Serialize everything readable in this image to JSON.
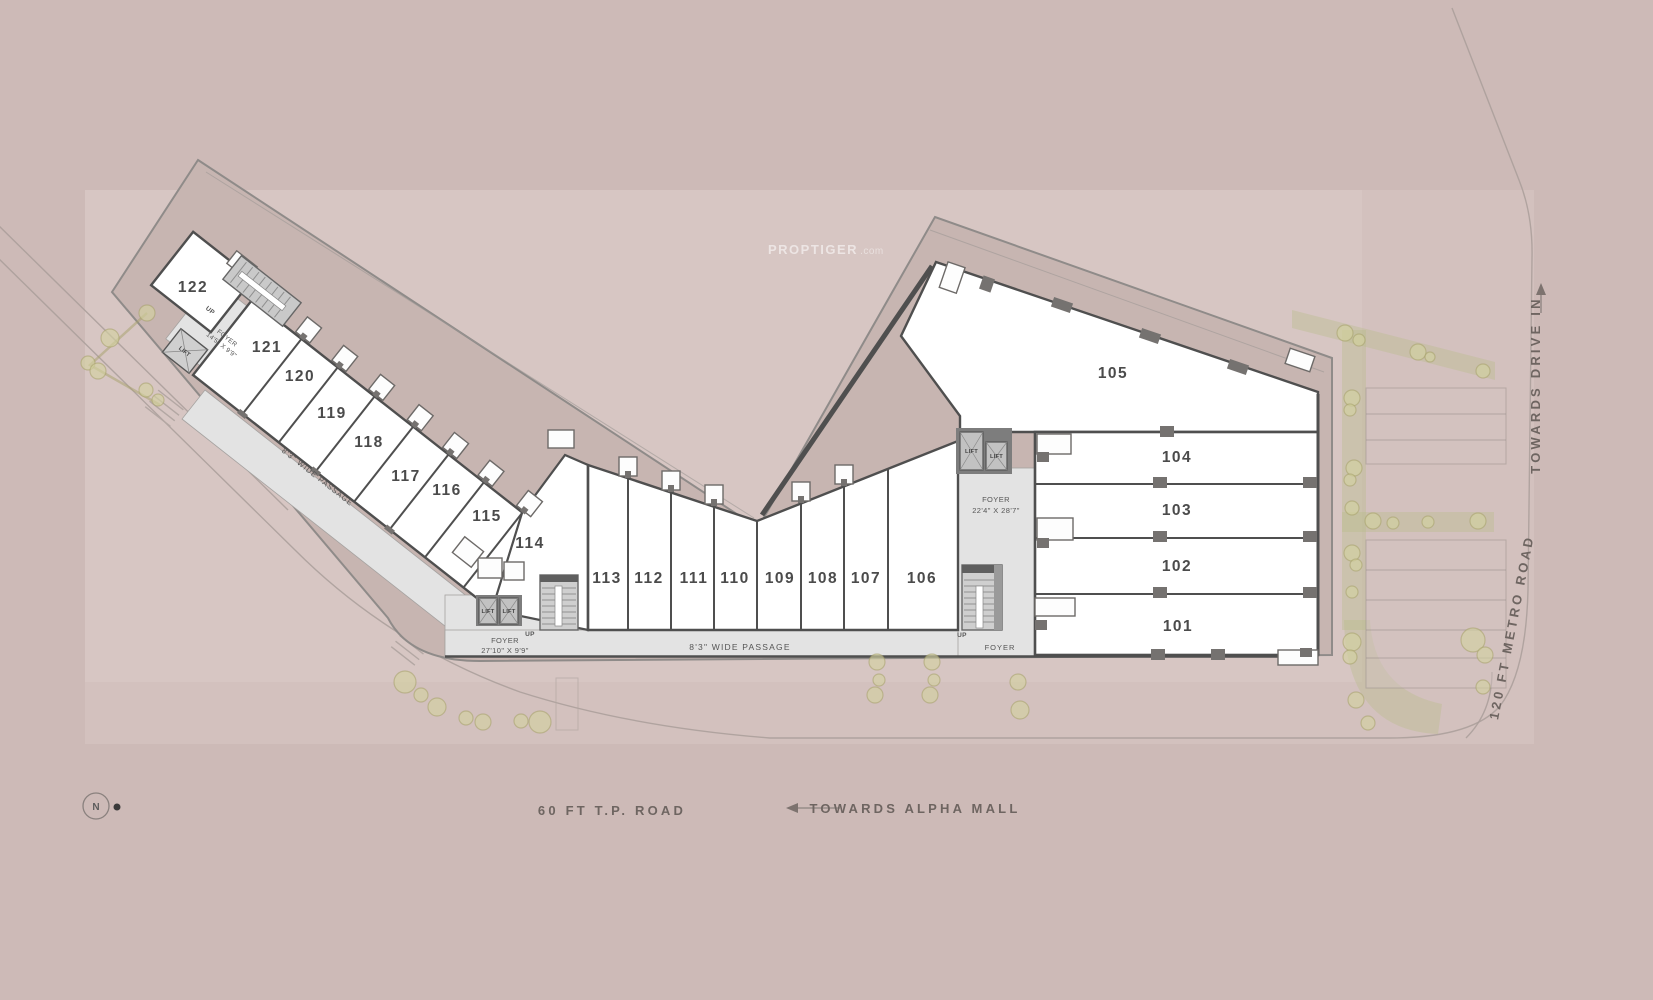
{
  "watermark": {
    "brand": "PROPTIGER",
    "suffix": ".com"
  },
  "compass": {
    "label": "N"
  },
  "roads": {
    "tp_road": "60 FT T.P. ROAD",
    "alpha_mall": "TOWARDS ALPHA MALL",
    "metro_road": "120 FT METRO ROAD",
    "drive_in": "TOWARDS DRIVE IN"
  },
  "labels": {
    "lift": "LIFT",
    "up": "UP",
    "foyer": "FOYER",
    "passage": "8'3\" WIDE PASSAGE",
    "foyer_left_dim": "27'10\" X 9'9\"",
    "foyer_122_dim": "14'5\" X 9'9\"",
    "foyer_right_dim": "22'4\" X 28'7\""
  },
  "units": [
    {
      "label": "101"
    },
    {
      "label": "102"
    },
    {
      "label": "103"
    },
    {
      "label": "104"
    },
    {
      "label": "105"
    },
    {
      "label": "106"
    },
    {
      "label": "107"
    },
    {
      "label": "108"
    },
    {
      "label": "109"
    },
    {
      "label": "110"
    },
    {
      "label": "111"
    },
    {
      "label": "112"
    },
    {
      "label": "113"
    },
    {
      "label": "114"
    },
    {
      "label": "115"
    },
    {
      "label": "116"
    },
    {
      "label": "117"
    },
    {
      "label": "118"
    },
    {
      "label": "119"
    },
    {
      "label": "120"
    },
    {
      "label": "121"
    },
    {
      "label": "122"
    }
  ],
  "colors": {
    "background": "#cdbab7",
    "site": "#d7c6c3",
    "overhang": "#c7b5b1",
    "unit_fill": "#ffffff",
    "wall": "#4f4f4f",
    "passage": "#e3e3e3",
    "tree": "#d4d2a0"
  }
}
